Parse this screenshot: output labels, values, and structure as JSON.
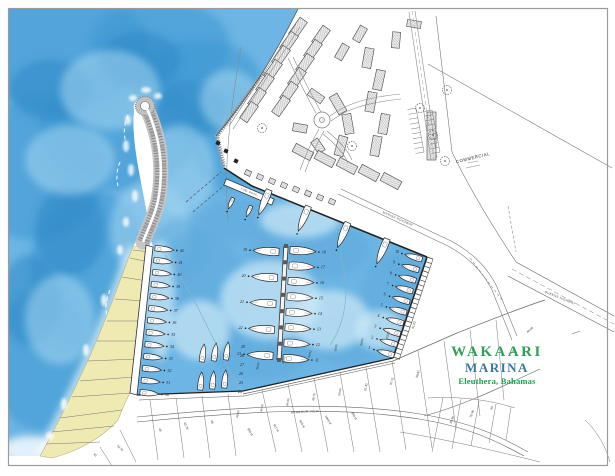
{
  "title_block": {
    "line1": "WAKAARI",
    "line2": "MARINA",
    "line3": "Eleuthera, Bahamas",
    "color1": "#2e9f55",
    "color2": "#39789f",
    "color3": "#18a14d"
  },
  "labels": {
    "commercial": "COMMERCIAL",
    "fuel_dock": "FUEL DOCK",
    "road_ne": "MARINA  ROADWAY",
    "road_e": "QUEENS  HIGHWAY",
    "road_s": "HARBOUR  VIEW"
  },
  "colors": {
    "ocean_base": "#6cb5e4",
    "ocean_deep": "#3e97d2",
    "ocean_deeper": "#2b85c4",
    "ocean_light": "#9dd1ef",
    "basin_dark": "#5ea9dc",
    "basin_light": "#cde9f7",
    "beach": "#efeab2",
    "line_dark": "#222222",
    "rock": "#9e9e9e"
  },
  "marina": {
    "slip_rows": [
      {
        "name": "west-quay-slips",
        "from": [
          153,
          248
        ],
        "to": [
          138,
          392
        ],
        "numbers": [
          42,
          41,
          40,
          39,
          38,
          37,
          36,
          35,
          34,
          33,
          32,
          31,
          30
        ],
        "side": 1,
        "len": 19,
        "beam": 6.5
      },
      {
        "name": "center-pier-west-slips",
        "from": [
          281,
          252
        ],
        "to": [
          275,
          356
        ],
        "numbers": [
          19,
          20,
          21,
          22,
          23
        ],
        "side": -1,
        "len": 26,
        "beam": 9
      },
      {
        "name": "center-pier-east-slips",
        "from": [
          288,
          250
        ],
        "to": [
          281,
          358
        ],
        "numbers": [
          18,
          17,
          16,
          15,
          14,
          13,
          12,
          11
        ],
        "side": 1,
        "len": 26,
        "beam": 9
      },
      {
        "name": "east-quay-slips",
        "from": [
          424,
          260
        ],
        "to": [
          396,
          356
        ],
        "numbers": [
          10,
          9,
          8,
          7,
          6,
          5,
          4,
          3,
          2,
          1
        ],
        "side": -1,
        "len": 18,
        "beam": 6.5
      },
      {
        "name": "north-quay-yachts",
        "from": [
          270,
          188
        ],
        "to": [
          388,
          237
        ],
        "numbers": [],
        "count": 4,
        "side": -1,
        "len": 27,
        "beam": 8
      },
      {
        "name": "fuel-dock-boats",
        "from": [
          234,
          196
        ],
        "to": [
          252,
          204
        ],
        "numbers": [],
        "count": 2,
        "side": -1,
        "len": 12,
        "beam": 4.5
      }
    ],
    "south_cluster_boats": [
      {
        "x": 203,
        "y": 353,
        "r": 8
      },
      {
        "x": 215,
        "y": 352,
        "r": 8
      },
      {
        "x": 227,
        "y": 351,
        "r": 8
      },
      {
        "x": 201,
        "y": 381,
        "r": 5
      },
      {
        "x": 213,
        "y": 380,
        "r": 5
      },
      {
        "x": 225,
        "y": 379,
        "r": 5
      }
    ],
    "south_cluster_numbers": [
      {
        "n": 29,
        "x": 243,
        "y": 347
      },
      {
        "n": 28,
        "x": 242,
        "y": 356
      },
      {
        "n": 27,
        "x": 242,
        "y": 365
      },
      {
        "n": 26,
        "x": 241,
        "y": 374
      },
      {
        "n": 25,
        "x": 241,
        "y": 383
      },
      {
        "n": 24,
        "x": 240,
        "y": 392
      }
    ]
  },
  "lot_labels": [
    {
      "t": "46.02",
      "x": 258,
      "y": 366,
      "r": -78
    },
    {
      "t": "64.02",
      "x": 284,
      "y": 360,
      "r": -78
    },
    {
      "t": "44.02",
      "x": 310,
      "y": 354,
      "r": -78
    },
    {
      "t": "18.02",
      "x": 336,
      "y": 348,
      "r": -78
    },
    {
      "t": "64.02",
      "x": 362,
      "y": 342,
      "r": -78
    },
    {
      "t": "63.02",
      "x": 388,
      "y": 335,
      "r": -75
    },
    {
      "t": "61.02",
      "x": 414,
      "y": 325,
      "r": -72
    },
    {
      "t": "45.00",
      "x": 238,
      "y": 414,
      "r": -80
    },
    {
      "t": "44.05",
      "x": 262,
      "y": 408,
      "r": -80
    },
    {
      "t": "64.05",
      "x": 288,
      "y": 402,
      "r": -80
    },
    {
      "t": "49.75",
      "x": 314,
      "y": 397,
      "r": -80
    },
    {
      "t": "50.00",
      "x": 340,
      "y": 392,
      "r": -80
    },
    {
      "t": "51.42",
      "x": 366,
      "y": 387,
      "r": -78
    },
    {
      "t": "57.21",
      "x": 392,
      "y": 381,
      "r": -75
    },
    {
      "t": "58.87",
      "x": 418,
      "y": 374,
      "r": -72
    },
    {
      "t": "999 sf",
      "x": 250,
      "y": 432,
      "r": 60
    },
    {
      "t": "917 sf",
      "x": 276,
      "y": 428,
      "r": 60
    },
    {
      "t": "910 sf",
      "x": 302,
      "y": 424,
      "r": 60
    },
    {
      "t": "1040 sf",
      "x": 328,
      "y": 420,
      "r": 60
    },
    {
      "t": "999 sf",
      "x": 354,
      "y": 416,
      "r": 60
    },
    {
      "t": "45",
      "x": 160,
      "y": 430,
      "r": 70
    },
    {
      "t": "52.76",
      "x": 186,
      "y": 426,
      "r": 65
    },
    {
      "t": "48",
      "x": 212,
      "y": 422,
      "r": 65
    },
    {
      "t": "35.36",
      "x": 452,
      "y": 420,
      "r": -70
    },
    {
      "t": "70.36",
      "x": 472,
      "y": 414,
      "r": -70
    },
    {
      "t": "50",
      "x": 492,
      "y": 408,
      "r": -70
    },
    {
      "t": "64.05",
      "x": 512,
      "y": 352,
      "r": -40
    },
    {
      "t": "44.05",
      "x": 530,
      "y": 330,
      "r": -40
    },
    {
      "t": "45",
      "x": 95,
      "y": 455,
      "r": 40
    },
    {
      "t": "52.76",
      "x": 120,
      "y": 448,
      "r": 45
    }
  ]
}
